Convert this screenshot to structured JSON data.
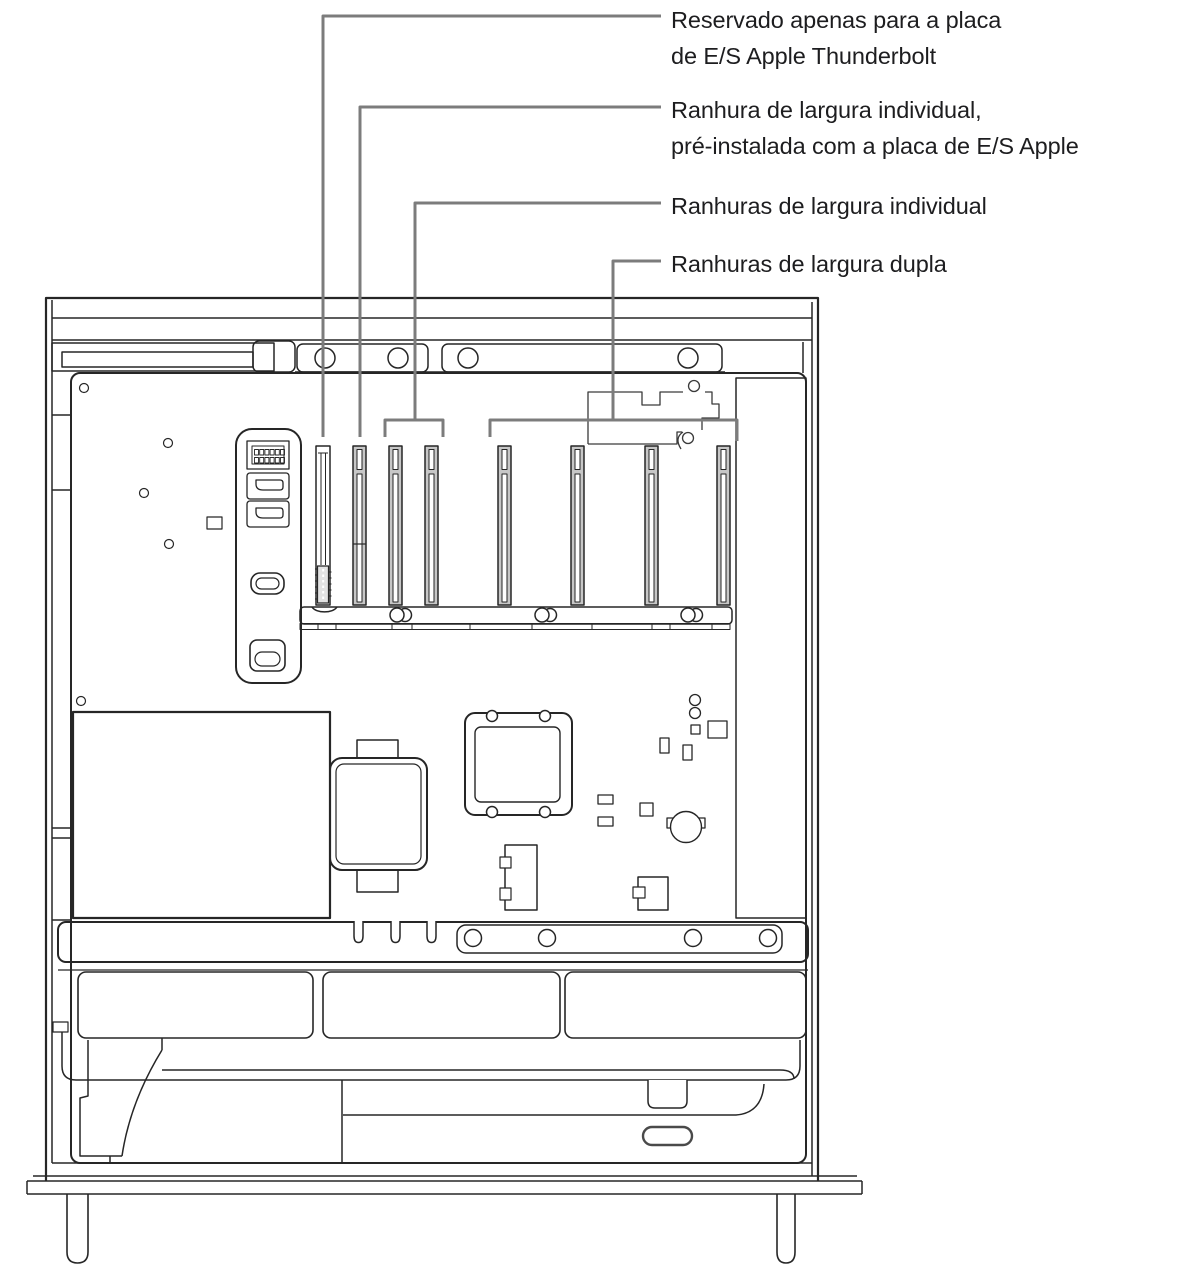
{
  "callouts": [
    {
      "id": "thunderbolt-reserved",
      "lines": [
        "Reservado apenas para a placa",
        "de E/S Apple Thunderbolt"
      ]
    },
    {
      "id": "single-width-preinstalled",
      "lines": [
        "Ranhura de largura individual,",
        "pré-instalada com a placa de E/S Apple"
      ]
    },
    {
      "id": "single-width-slots",
      "lines": [
        "Ranhuras de largura individual"
      ]
    },
    {
      "id": "double-width-slots",
      "lines": [
        "Ranhuras de largura dupla"
      ]
    }
  ],
  "colors": {
    "background": "#ffffff",
    "ink": "#1d1d1f",
    "line_art": "#262626",
    "callout_line": "#7c7c7c",
    "slot_fill": "#c7c7c7",
    "connector_fill": "#e2e2e2"
  }
}
